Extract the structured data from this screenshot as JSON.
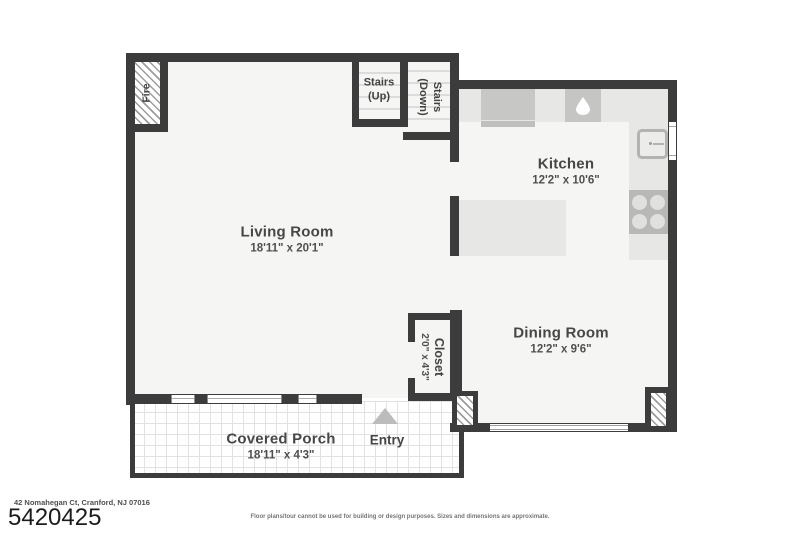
{
  "plan": {
    "rooms": {
      "living": {
        "name": "Living Room",
        "dims": "18'11\" x 20'1\""
      },
      "kitchen": {
        "name": "Kitchen",
        "dims": "12'2\" x 10'6\""
      },
      "dining": {
        "name": "Dining Room",
        "dims": "12'2\" x 9'6\""
      },
      "porch": {
        "name": "Covered Porch",
        "dims": "18'11\" x 4'3\""
      },
      "closet": {
        "name": "Closet",
        "dims": "2'0\" x 4'3\""
      }
    },
    "features": {
      "entry": "Entry",
      "fireplace": "Fire",
      "stairs_up_l1": "Stairs",
      "stairs_up_l2": "(Up)",
      "stairs_down_l1": "Stairs",
      "stairs_down_l2": "(Down)"
    },
    "icons": {
      "sink": "water-drop",
      "stove": "four-burner-cooktop",
      "refrigerator": "fridge-outline",
      "entry_arrow": "triangle-up"
    },
    "colors": {
      "wall": "#3c3c3c",
      "room_fill": "#f5f5f4",
      "counter": "#e7e7e6",
      "appliance": "#c7c7c6",
      "stove": "#b8b8b7",
      "label_text": "#474747"
    }
  },
  "footer": {
    "address": "42 Nomahegan Ct, Cranford, NJ 07016",
    "listing_number": "5420425",
    "disclaimer": "Floor plans/tour cannot be used for building or design purposes. Sizes and dimensions are approximate."
  }
}
